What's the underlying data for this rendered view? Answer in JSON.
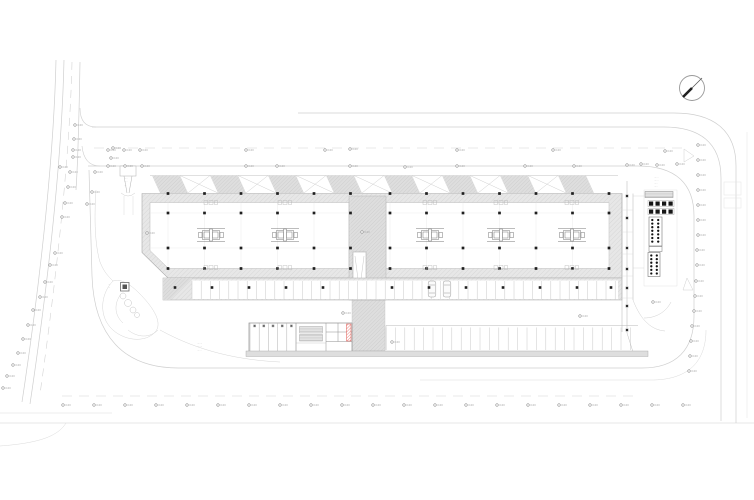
{
  "page": {
    "kind": "architectural-site-plan",
    "sheet_background": "#ffffff"
  },
  "colors": {
    "ink": "#1f1f1f",
    "line_dark": "#8f8f8f",
    "line_mid": "#b5b5b5",
    "line_light": "#d6d6d6",
    "fill_band": "#e7e7e7",
    "fill_mid": "#dedede",
    "accent_red": "#e0524c",
    "marker": "#8c8c8c",
    "text": "#a3a3a3"
  },
  "north_arrow": {
    "cx": 692,
    "cy": 88,
    "r": 12.5
  },
  "spot_markers": {
    "label": "0.00",
    "positions": [
      [
        108,
        150
      ],
      [
        124,
        150
      ],
      [
        140,
        150
      ],
      [
        246,
        150
      ],
      [
        325,
        150
      ],
      [
        350,
        149
      ],
      [
        457,
        150
      ],
      [
        553,
        150
      ],
      [
        665,
        151
      ],
      [
        60,
        167
      ],
      [
        108,
        166
      ],
      [
        125,
        166
      ],
      [
        142,
        166
      ],
      [
        246,
        166
      ],
      [
        277,
        166
      ],
      [
        350,
        166
      ],
      [
        405,
        167
      ],
      [
        457,
        166
      ],
      [
        525,
        166
      ],
      [
        574,
        166
      ],
      [
        627,
        165
      ],
      [
        641,
        164
      ],
      [
        657,
        165
      ],
      [
        677,
        164
      ],
      [
        75,
        125
      ],
      [
        74,
        139
      ],
      [
        73,
        150
      ],
      [
        73,
        157
      ],
      [
        70,
        172
      ],
      [
        68,
        187
      ],
      [
        65,
        203
      ],
      [
        62,
        217
      ],
      [
        55,
        253
      ],
      [
        50,
        265
      ],
      [
        45,
        282
      ],
      [
        40,
        297
      ],
      [
        33,
        310
      ],
      [
        28,
        325
      ],
      [
        23,
        339
      ],
      [
        18,
        353
      ],
      [
        13,
        365
      ],
      [
        7,
        376
      ],
      [
        3,
        388
      ],
      [
        113,
        148
      ],
      [
        111,
        158
      ],
      [
        95,
        172
      ],
      [
        92,
        192
      ],
      [
        87,
        204
      ],
      [
        698,
        145
      ],
      [
        698,
        160
      ],
      [
        698,
        175
      ],
      [
        698,
        190
      ],
      [
        698,
        205
      ],
      [
        698,
        220
      ],
      [
        698,
        235
      ],
      [
        697,
        250
      ],
      [
        697,
        265
      ],
      [
        696,
        281
      ],
      [
        695,
        296
      ],
      [
        694,
        311
      ],
      [
        692,
        326
      ],
      [
        691,
        341
      ],
      [
        690,
        356
      ],
      [
        689,
        371
      ],
      [
        63,
        405
      ],
      [
        94,
        405
      ],
      [
        125,
        405
      ],
      [
        156,
        405
      ],
      [
        187,
        405
      ],
      [
        218,
        405
      ],
      [
        249,
        405
      ],
      [
        280,
        405
      ],
      [
        311,
        405
      ],
      [
        342,
        405
      ],
      [
        373,
        405
      ],
      [
        404,
        405
      ],
      [
        435,
        405
      ],
      [
        466,
        405
      ],
      [
        497,
        405
      ],
      [
        528,
        405
      ],
      [
        559,
        405
      ],
      [
        590,
        405
      ],
      [
        621,
        405
      ],
      [
        652,
        405
      ],
      [
        683,
        405
      ],
      [
        362,
        232
      ],
      [
        343,
        313
      ],
      [
        392,
        342
      ],
      [
        580,
        316
      ],
      [
        653,
        302
      ],
      [
        147,
        233
      ]
    ]
  },
  "column_grid": {
    "rows": [
      193.5,
      213,
      248,
      268.5
    ],
    "west_cols": [
      168,
      204.5,
      241,
      277.5,
      314,
      350.5
    ],
    "east_cols": [
      390,
      426.5,
      463,
      499.5,
      536,
      572.5,
      609
    ],
    "parking_row_y": 287.5,
    "parking_cols": [
      175,
      212,
      249,
      286,
      323,
      392,
      429,
      466,
      503,
      540,
      577,
      611
    ],
    "extension_col_x": 627,
    "extension_rows": [
      196,
      218,
      248,
      269,
      288,
      306,
      330
    ]
  },
  "cores": {
    "positions": [
      [
        211,
        235
      ],
      [
        285,
        235
      ],
      [
        430,
        235
      ],
      [
        501,
        235
      ],
      [
        572,
        235
      ]
    ]
  },
  "vent_clusters": {
    "positions": [
      [
        211,
        202.5
      ],
      [
        285,
        202.5
      ],
      [
        430,
        202.5
      ],
      [
        501,
        202.5
      ],
      [
        572,
        202.5
      ],
      [
        211,
        267.5
      ],
      [
        285,
        267.5
      ],
      [
        430,
        267.5
      ],
      [
        501,
        267.5
      ],
      [
        572,
        267.5
      ]
    ]
  },
  "canopy": {
    "x0": 152,
    "bays": 8,
    "period": 58,
    "y_top": 175.5,
    "y_bottom": 193,
    "bay_width": 28,
    "slant": 8
  },
  "parking": {
    "band": {
      "stall_x0": 192,
      "stall_x1": 620,
      "step": 9.2,
      "y0": 281,
      "y1": 299
    },
    "lower_row": {
      "x0": 386,
      "x1": 638,
      "step": 9.4,
      "y0": 327.5,
      "y1": 350
    },
    "service_row": {
      "x0": 250,
      "x1": 296,
      "step": 9.2,
      "y0": 323.5,
      "y1": 351.5
    }
  },
  "cars": {
    "positions": [
      [
        432,
        289
      ],
      [
        447,
        289
      ]
    ]
  },
  "trees": {
    "positions": [
      [
        123,
        296,
        3
      ],
      [
        128,
        303,
        3.5
      ],
      [
        133,
        310,
        3
      ],
      [
        137,
        315,
        2.5
      ]
    ]
  },
  "equipment": {
    "square_rows": {
      "xs": [
        649,
        655.5,
        662,
        668.5
      ],
      "ys": [
        201.5,
        209.5
      ],
      "size": 4.2
    },
    "block1": {
      "x": 649,
      "y": 217,
      "w": 13,
      "h": 29,
      "dot_cols": [
        652.3,
        658.2
      ],
      "dot_y0": 220,
      "dot_step": 3.6,
      "dot_rows": 7
    },
    "block2": {
      "x": 648,
      "y": 252.5,
      "w": 12,
      "h": 24,
      "dot_cols": [
        651.3,
        656.8
      ],
      "dot_y0": 255.5,
      "dot_step": 3.6,
      "dot_rows": 6
    }
  },
  "red_element": {
    "x": 346.5,
    "y": 324,
    "w": 4.5,
    "h": 17
  },
  "annotations": {
    "font_px": 2.4,
    "items": [
      {
        "x": 124,
        "y": 179,
        "text": "·····"
      },
      {
        "x": 124,
        "y": 182.5,
        "text": "·····"
      },
      {
        "x": 124,
        "y": 186,
        "text": "····"
      },
      {
        "x": 108,
        "y": 285,
        "text": "···"
      },
      {
        "x": 108,
        "y": 288,
        "text": "···"
      },
      {
        "x": 197,
        "y": 344,
        "text": "·······"
      },
      {
        "x": 197,
        "y": 347.5,
        "text": "·······"
      },
      {
        "x": 197,
        "y": 351,
        "text": "······"
      },
      {
        "x": 654,
        "y": 178,
        "text": "······"
      },
      {
        "x": 654,
        "y": 181,
        "text": "······"
      },
      {
        "x": 654,
        "y": 184,
        "text": "·····"
      },
      {
        "x": 654,
        "y": 187,
        "text": "·····"
      }
    ]
  }
}
